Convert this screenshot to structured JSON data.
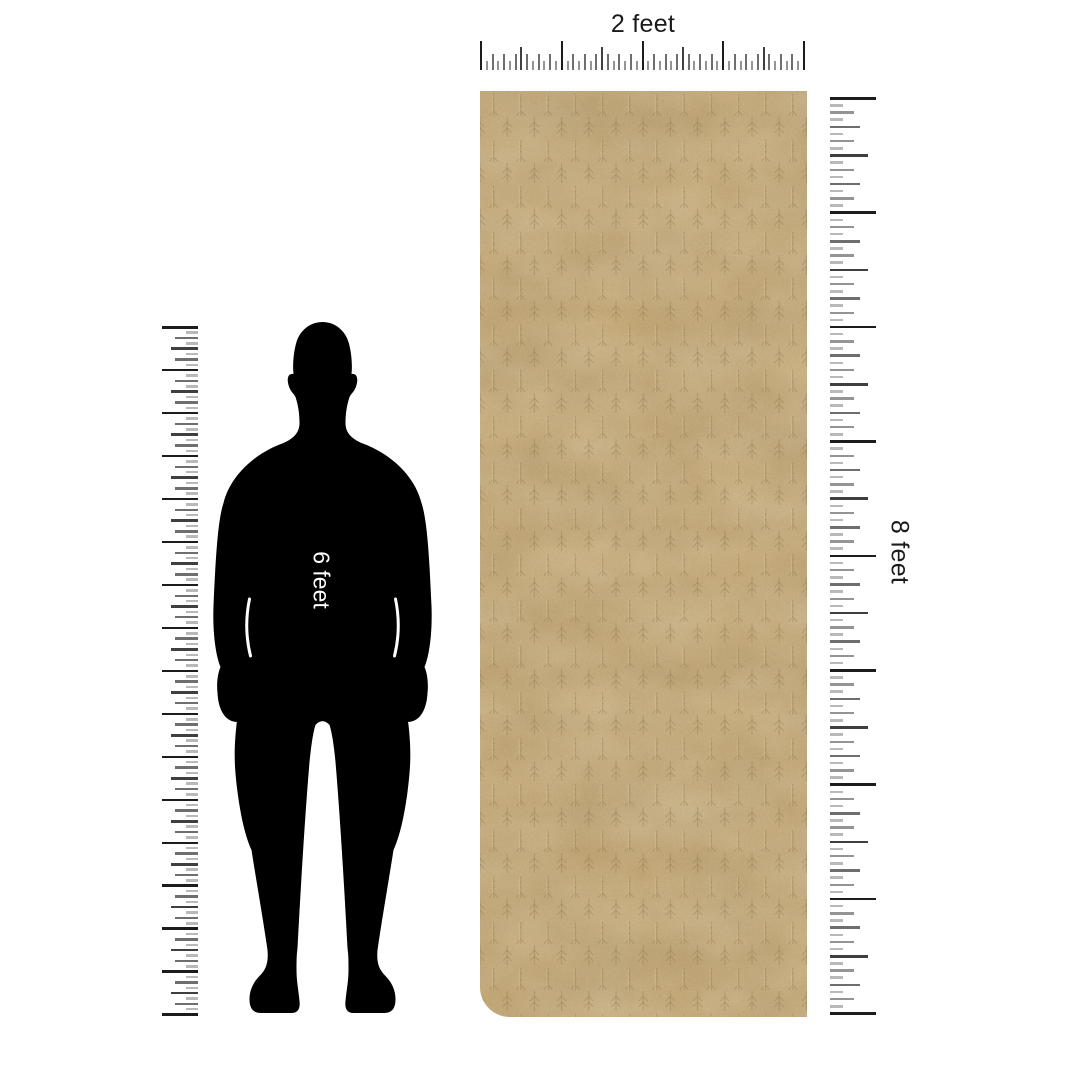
{
  "labels": {
    "width": "2 feet",
    "height": "8 feet",
    "person": "6 feet"
  },
  "measurements": {
    "product_width_label": "2 feet",
    "product_height_label": "8 feet",
    "person_height_label": "6 feet"
  },
  "colors": {
    "background": "#ffffff",
    "person": "#000000",
    "person_label": "#ffffff",
    "label_text": "#1b1b1b",
    "rug_base": "#c2a470",
    "rug_dark": "#8a7347",
    "rug_light": "#e6d2a2",
    "tick_major": "#1c1c1c",
    "tick_dark": "#3f3f3f",
    "tick_mid": "#6e6e6e",
    "tick_soft": "#949494",
    "tick_light": "#b9b9b9"
  }
}
